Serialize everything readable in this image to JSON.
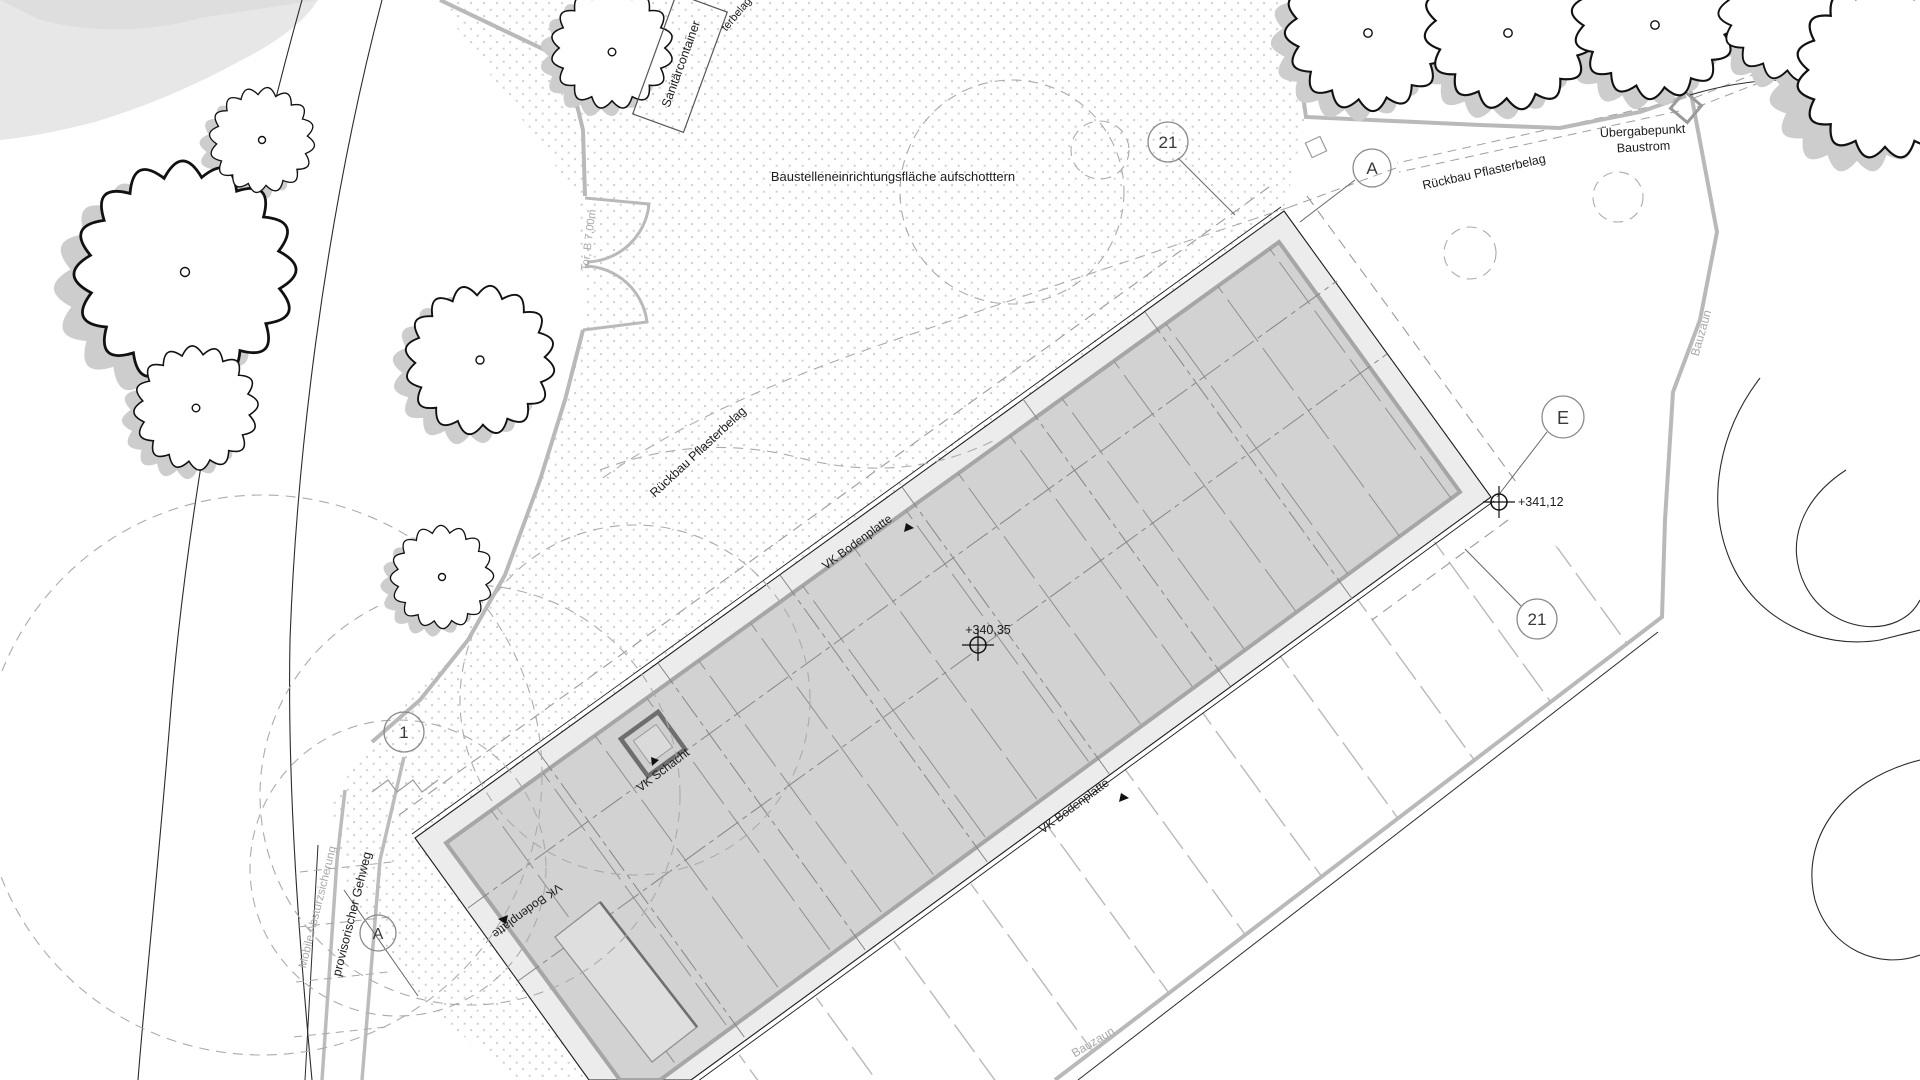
{
  "labels": {
    "site_area": "Baustelleneinrichtungsfläche aufschotttern",
    "sanitaer": "Sanitärcontainer",
    "uebergabe_line1": "Übergabepunkt",
    "uebergabe_line2": "Baustrom",
    "rueckbau": "Rückbau Pflasterbelag",
    "rueckbau_top_fragment": "terbelag",
    "vk_bodenplatte": "VK Bodenplatte",
    "vk_schacht": "VK Schacht",
    "bauzaun": "Bauzaun",
    "tor": "Tor, B 7,00m",
    "gehweg": "provisorischer Gehweg",
    "absturz": "Mobile Absturzsicherung"
  },
  "markers": {
    "detail_21_top": "21",
    "detail_21_right": "21",
    "grid_a_top": "A",
    "grid_a_bottom": "A",
    "grid_e": "E",
    "detail_1": "1"
  },
  "elevations": {
    "corner": "+341,12",
    "center": "+340,35"
  },
  "colors": {
    "slab_fill": "#d2d2d2",
    "slab_band": "#ececec",
    "slab_strip": "#a6a6a6",
    "fence_gray": "#b9b9b9",
    "dashed_gray": "#a3a3a3",
    "dot_gray": "#cccccc",
    "text_dark": "#1c1c1c",
    "text_gray": "#a9a9a9"
  }
}
